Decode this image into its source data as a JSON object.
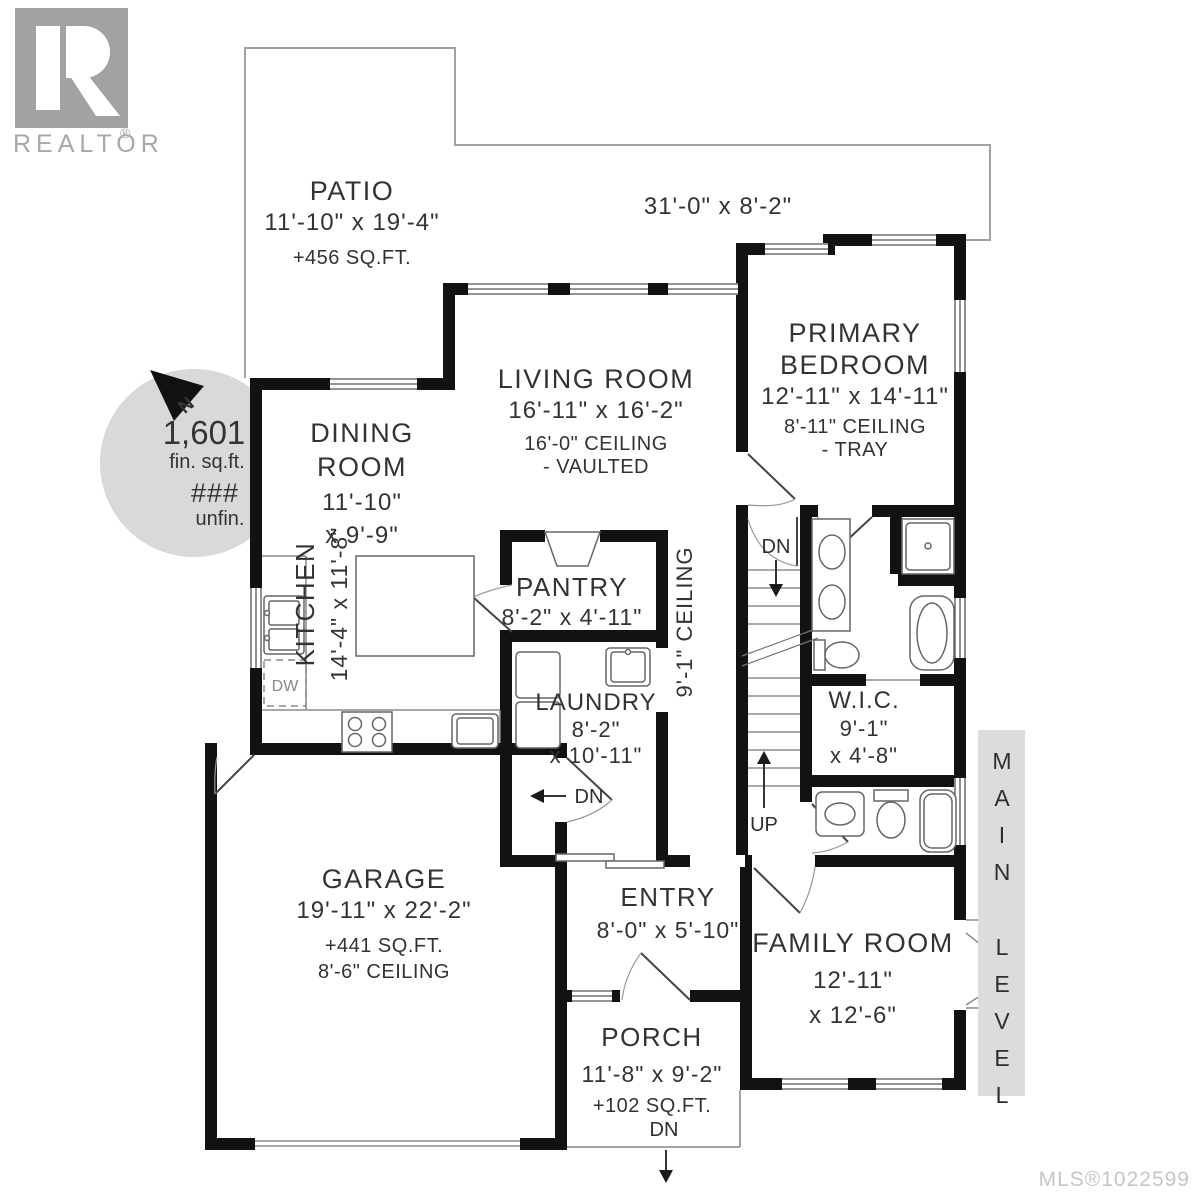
{
  "branding": {
    "logo_text": "REALTOR",
    "registered": "®"
  },
  "footer": {
    "mls": "MLS®1022599"
  },
  "level_badge": {
    "word1": "MAIN",
    "word2": "LEVEL"
  },
  "compass": {
    "north": "N"
  },
  "area_summary": {
    "finished_value": "1,601",
    "finished_label": "fin. sq.ft.",
    "unfinished_value": "###",
    "unfinished_label": "unfin."
  },
  "outdoor": {
    "patio": {
      "name": "PATIO",
      "dims": "11'-10\" x 19'-4\"",
      "area": "+456 SQ.FT."
    },
    "deck": {
      "dims": "31'-0\" x 8'-2\""
    },
    "porch": {
      "name": "PORCH",
      "dims": "11'-8\" x 9'-2\"",
      "area": "+102 SQ.FT."
    }
  },
  "rooms": {
    "living": {
      "name": "LIVING ROOM",
      "dims": "16'-11\" x 16'-2\"",
      "ceiling": "16'-0\" CEILING",
      "ceiling_note": "- VAULTED"
    },
    "dining": {
      "name_line1": "DINING",
      "name_line2": "ROOM",
      "dims_line1": "11'-10\"",
      "dims_line2": "x 9'-9\""
    },
    "primary_bedroom": {
      "name_line1": "PRIMARY",
      "name_line2": "BEDROOM",
      "dims": "12'-11\" x 14'-11\"",
      "ceiling": "8'-11\" CEILING",
      "ceiling_note": "- TRAY"
    },
    "kitchen": {
      "name": "KITCHEN",
      "dims": "14'-4\" x 11'-8\""
    },
    "pantry": {
      "name": "PANTRY",
      "dims": "8'-2\" x 4'-11\""
    },
    "laundry": {
      "name": "LAUNDRY",
      "dims_line1": "8'-2\"",
      "dims_line2": "x 10'-11\""
    },
    "wic": {
      "name": "W.I.C.",
      "dims_line1": "9'-1\"",
      "dims_line2": "x 4'-8\""
    },
    "stairwell": {
      "ceiling": "9'-1\" CEILING"
    },
    "garage": {
      "name": "GARAGE",
      "dims": "19'-11\" x 22'-2\"",
      "area": "+441 SQ.FT.",
      "ceiling": "8'-6\" CEILING"
    },
    "entry": {
      "name": "ENTRY",
      "dims": "8'-0\" x 5'-10\""
    },
    "family_room": {
      "name": "FAMILY ROOM",
      "dims_line1": "12'-11\"",
      "dims_line2": "x 12'-6\""
    }
  },
  "annotations": {
    "stairs_down": "DN",
    "stairs_up": "UP",
    "garage_step_down": "DN",
    "porch_step_down": "DN",
    "dishwasher": "DW"
  },
  "colors": {
    "wall": "#121212",
    "circle_gray": "#d9d9d9",
    "logo_gray": "#a2a2a2",
    "mls_gray": "#c6c6c6",
    "badge_gray": "#dcdcdc"
  }
}
